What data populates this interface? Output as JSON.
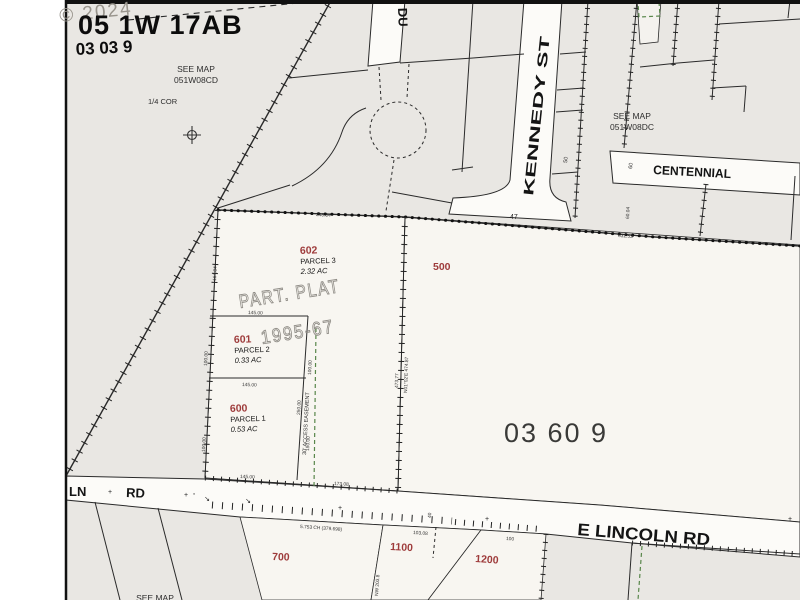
{
  "map": {
    "title": "05 1W 17AB",
    "subtitle": "03 03 9",
    "watermark": "© 2024",
    "area_label": "03 60 9",
    "plat_line1": "PART. PLAT",
    "plat_line2": "1995-67",
    "easement_label": "30' ACCESS EASEMENT"
  },
  "references": {
    "nw_line1": "SEE MAP",
    "nw_line2": "051W08CD",
    "ne_line1": "SEE MAP",
    "ne_line2": "051W08DC",
    "south": "SEE MAP",
    "quarter_corner": "1/4 COR"
  },
  "streets": {
    "du": "DU",
    "kennedy": "KENNEDY  ST",
    "centennial": "CENTENNIAL",
    "lincoln": "E LINCOLN RD",
    "lincoln_ln": "LN",
    "lincoln_rd": "RD"
  },
  "parcels": [
    {
      "id": "602",
      "parcel": "PARCEL 3",
      "acres": "2.32 AC"
    },
    {
      "id": "601",
      "parcel": "PARCEL 2",
      "acres": "0.33 AC"
    },
    {
      "id": "600",
      "parcel": "PARCEL 1",
      "acres": "0.53 AC"
    },
    {
      "id": "500"
    },
    {
      "id": "700"
    },
    {
      "id": "1100"
    },
    {
      "id": "1200"
    }
  ],
  "dimensions": [
    {
      "text": "248.84"
    },
    {
      "text": "632.53"
    },
    {
      "text": "164.84"
    },
    {
      "text": "145.00"
    },
    {
      "text": "100.00"
    },
    {
      "text": "100.00"
    },
    {
      "text": "145.00"
    },
    {
      "text": "100.00"
    },
    {
      "text": "150.00"
    },
    {
      "text": "250.00"
    },
    {
      "text": "473.77"
    },
    {
      "text": "N01°02'E 474.87"
    },
    {
      "text": "145.00"
    },
    {
      "text": "173.08"
    },
    {
      "text": "5.753 CH (379.698)"
    },
    {
      "text": "103.08"
    },
    {
      "text": "100"
    },
    {
      "text": "40"
    },
    {
      "text": "47"
    },
    {
      "text": "50"
    },
    {
      "text": "60"
    },
    {
      "text": "60.04"
    },
    {
      "text": "NW 203.8"
    }
  ],
  "symbols": {
    "cross": "+",
    "dot": "◦",
    "arrow": "↘"
  },
  "colors": {
    "parcel_number": "#9e3b3b",
    "easement_green": "#58864a",
    "background_grey": "#e9e7e3",
    "parcel_fill": "#f8f6f1"
  }
}
